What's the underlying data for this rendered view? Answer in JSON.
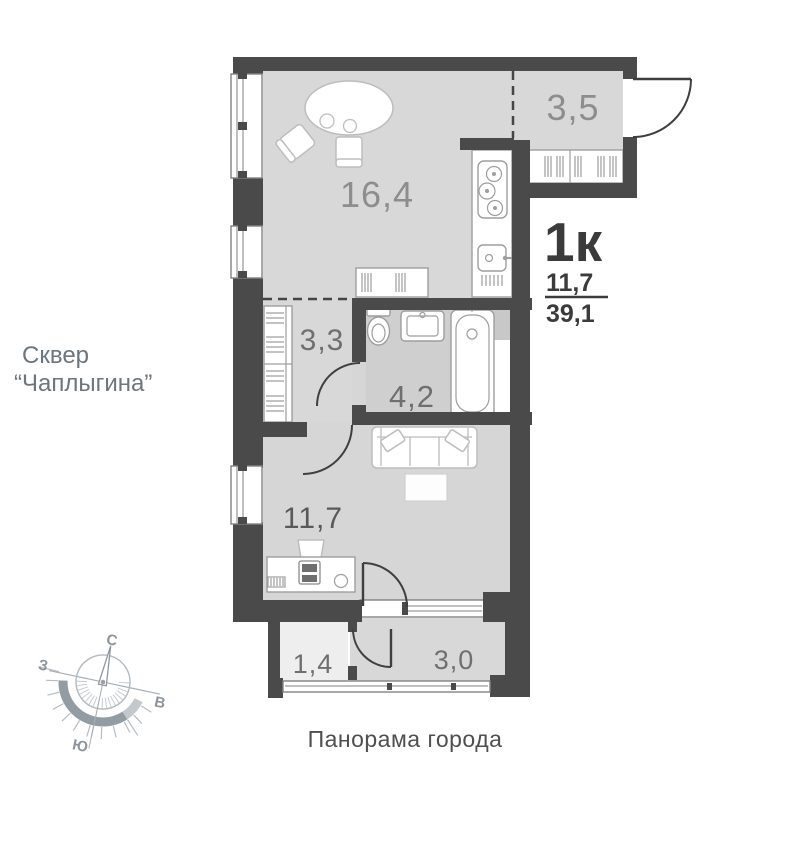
{
  "apartment": {
    "type_label": "1к",
    "living_area": "11,7",
    "total_area": "39,1"
  },
  "rooms": {
    "living_kitchen": "16,4",
    "entry_hall": "3,5",
    "corridor": "3,3",
    "bathroom": "4,2",
    "bedroom": "11,7",
    "balcony_small": "1,4",
    "balcony": "3,0"
  },
  "annotations": {
    "left_note_line1": "Сквер",
    "left_note_line2": "“Чаплыгина”",
    "bottom_note": "Панорама города"
  },
  "compass": {
    "north": "С",
    "south": "Ю",
    "west": "З",
    "east": "В"
  },
  "colors": {
    "wall": "#4a4a4a",
    "floor": "#d8d8d8",
    "floor_bathroom": "#cfcfcf",
    "floor_balcony_small": "#eeeeee",
    "area_text": "#3b3b3b",
    "room_label": "#8d8d8d",
    "note_text": "#6d757d"
  }
}
